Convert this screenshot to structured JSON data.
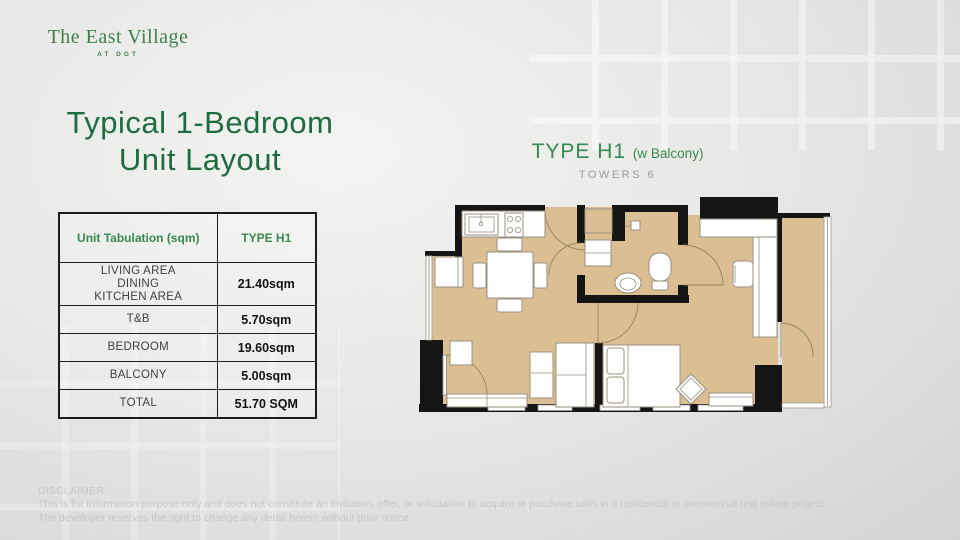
{
  "brand": {
    "name": "The East Village",
    "tagline": "AT DGT"
  },
  "title": {
    "line1": "Typical 1-Bedroom",
    "line2": "Unit Layout"
  },
  "plan": {
    "type_label": "TYPE H1",
    "type_suffix": "(w Balcony)",
    "towers": "TOWERS 6"
  },
  "table": {
    "headers": [
      "Unit Tabulation (sqm)",
      "TYPE H1"
    ],
    "rows": [
      {
        "label": "LIVING AREA\nDINING\nKITCHEN AREA",
        "value": "21.40sqm"
      },
      {
        "label": "T&B",
        "value": "5.70sqm"
      },
      {
        "label": "BEDROOM",
        "value": "19.60sqm"
      },
      {
        "label": "BALCONY",
        "value": "5.00sqm"
      },
      {
        "label": "TOTAL",
        "value": "51.70 SQM"
      }
    ]
  },
  "disclaimer": {
    "heading": "DISCLAIMER",
    "line1": "This is for information purpose only and does not constitute an invitation, offer, or solicitation to acquire or purchase units in a residential or commercial real estate project.",
    "line2": "The developer reserves the right to change any detail herein without prior notice."
  },
  "theme": {
    "logo_green": "#3f7f4b",
    "title_green": "#1e6c41",
    "header_green": "#368a4f",
    "towers_gray": "#9a9a9a",
    "floor_tan": "#dcbe93",
    "wall_black": "#151515",
    "furniture_line": "#9a9080",
    "table_border": "#1c1c1c",
    "label_gray": "#3f3f3f",
    "value_black": "#121212",
    "disclaimer_gray": "#c6c6c8"
  }
}
